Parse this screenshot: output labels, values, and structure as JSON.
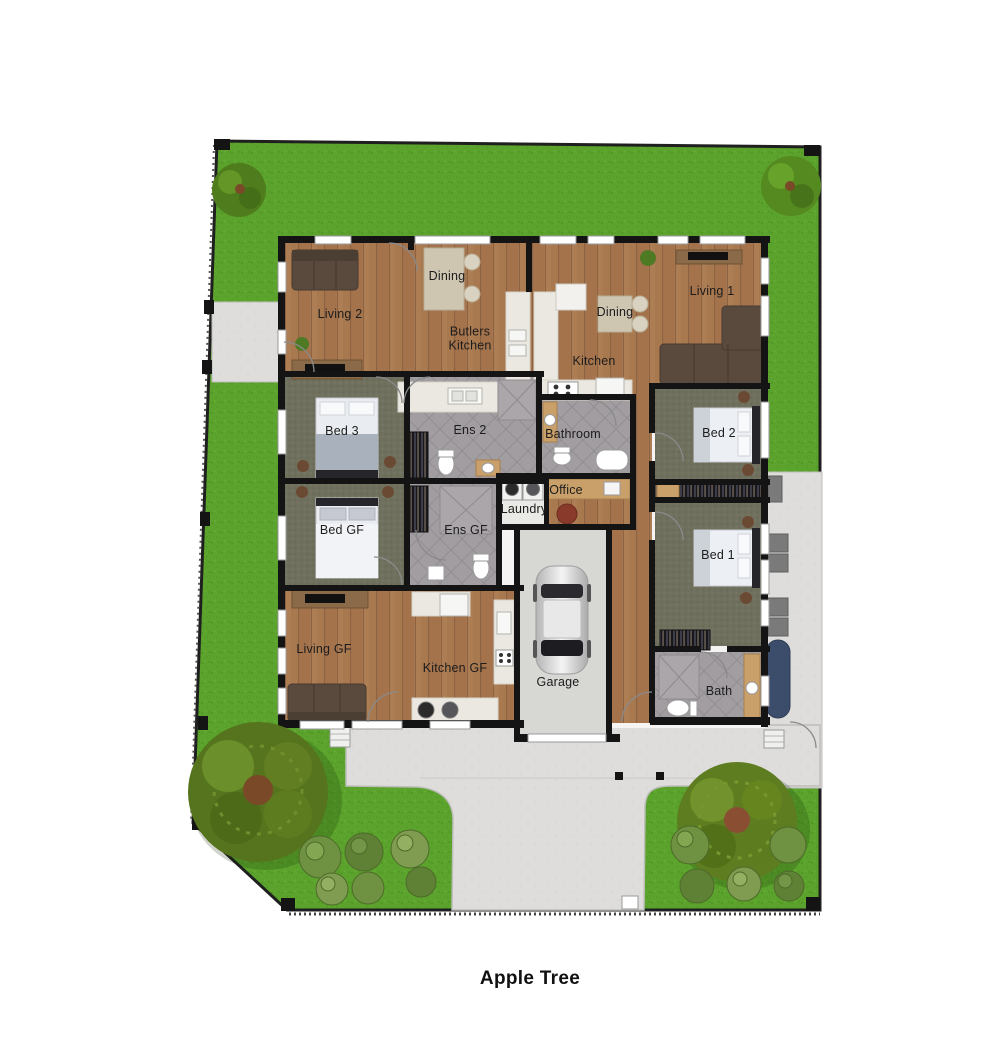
{
  "title": "Apple Tree",
  "rooms": {
    "living2": "Living 2",
    "dining_a": "Dining",
    "butlers_kitchen": "Butlers Kitchen",
    "dining_b": "Dining",
    "living1": "Living 1",
    "kitchen": "Kitchen",
    "bed3": "Bed 3",
    "ens2": "Ens 2",
    "bathroom": "Bathroom",
    "bed2": "Bed 2",
    "bed_gf": "Bed GF",
    "ens_gf": "Ens GF",
    "laundry": "Laundry",
    "office": "Office",
    "bed1": "Bed 1",
    "living_gf": "Living GF",
    "kitchen_gf": "Kitchen GF",
    "garage": "Garage",
    "bath": "Bath"
  },
  "colors": {
    "grass": "#5ba32c",
    "wood": "#a8784f",
    "carpet": "#70705f",
    "tile": "#a19da1",
    "concrete": "#dedddb",
    "garage_floor": "#d7d7d4",
    "wall": "#141414",
    "kayak": "#3c4d6b",
    "title_text": "#111111"
  }
}
